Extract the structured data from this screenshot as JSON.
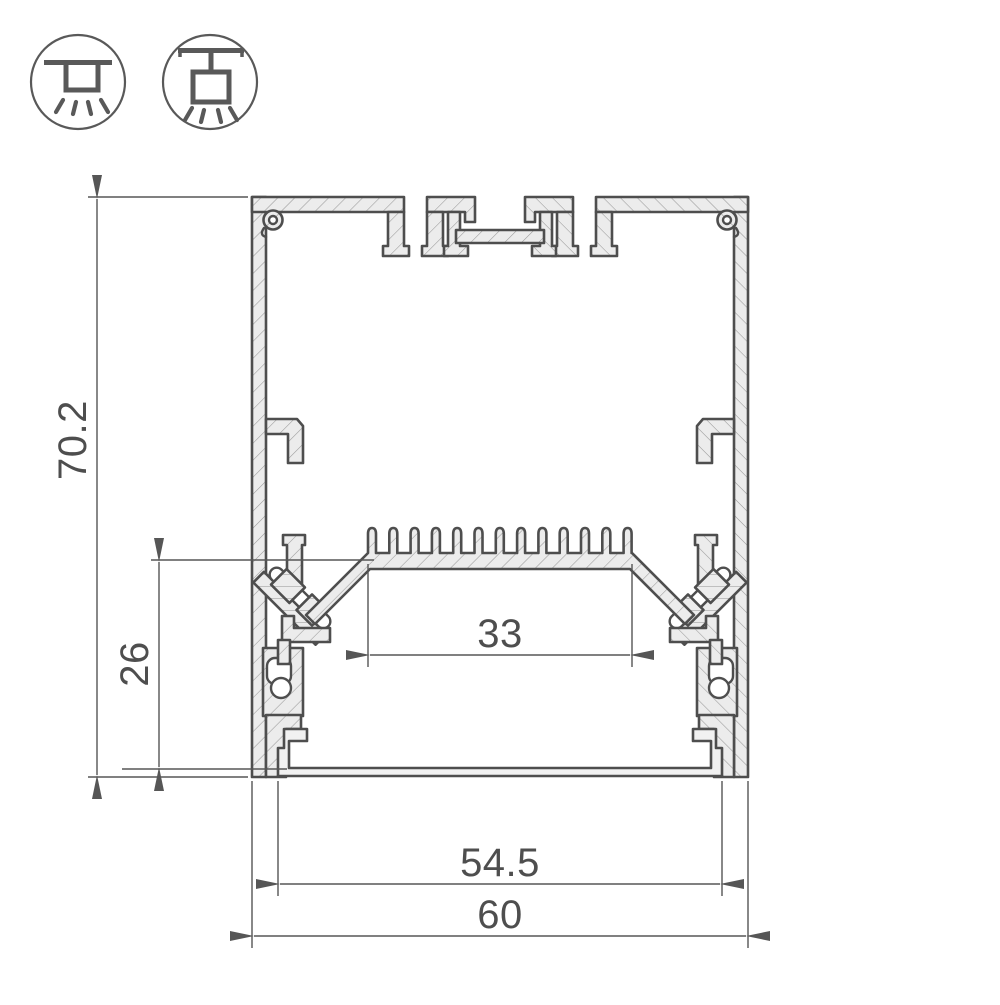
{
  "drawing": {
    "dimensions": {
      "total_height": "70.2",
      "bottom_to_led_shelf": "26",
      "led_shelf_width": "33",
      "inner_width": "54.5",
      "total_width": "60"
    }
  },
  "icons": {
    "left": "surface-mount-light-icon",
    "right": "pendant-light-icon"
  },
  "colors": {
    "outline": "#4e4e4e",
    "aluminum_fill": "#ececec",
    "hatch": "#999999",
    "dimension": "#565656",
    "background": "#ffffff"
  }
}
